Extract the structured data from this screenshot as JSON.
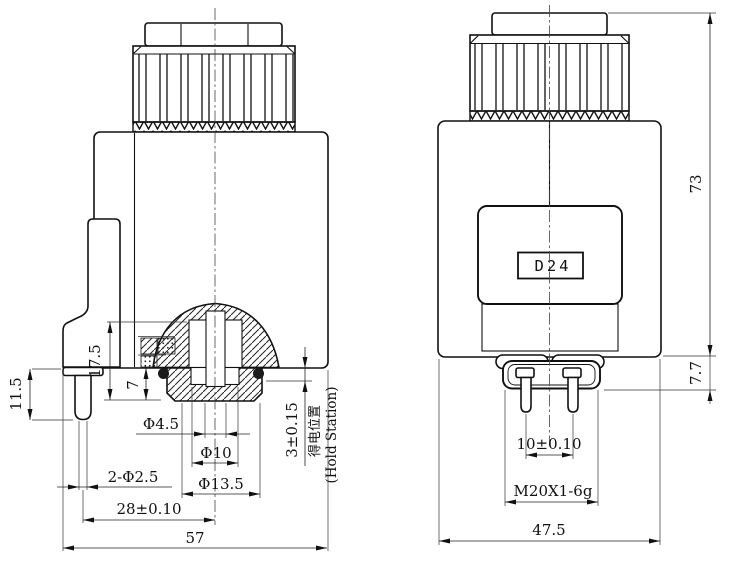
{
  "colors": {
    "ink": "#111111",
    "background": "#ffffff"
  },
  "front_view": {
    "name": "front sectional view",
    "dim_pin_length": "11.5",
    "dim_armature_depth": "17.5",
    "dim_plug_protrusion": "7",
    "dim_bore_diameter": "Φ4.5",
    "dim_counterbore_diameter": "Φ10",
    "dim_pin_diameter": "2-Φ2.5",
    "dim_plug_diameter": "Φ13.5",
    "dim_pin_to_center": "28±0.10",
    "dim_overall_width": "57",
    "dim_stroke": "3±0.15",
    "label_hold_station_cn": "得电位置",
    "label_hold_station_en": "(Hold Station)"
  },
  "side_view": {
    "name": "side view",
    "dim_overall_height": "73",
    "dim_terminal_height": "7.7",
    "label_voltage": "D24",
    "dim_terminal_pitch": "10±0.10",
    "label_thread": "M20X1-6g",
    "dim_body_width": "47.5"
  }
}
